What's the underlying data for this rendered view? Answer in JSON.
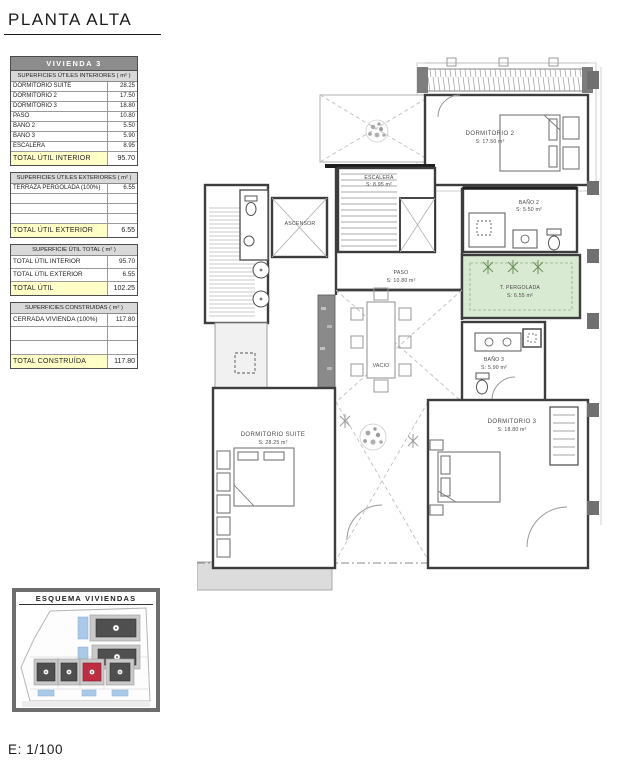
{
  "page": {
    "title": "PLANTA ALTA",
    "scale_label": "E: 1/100"
  },
  "colors": {
    "header_gray": "#8c8c8c",
    "subheader_gray": "#d9d9d9",
    "total_yellow": "#ffffc8",
    "pergola_green": "#d9ead3",
    "highlight_red": "#c02d42",
    "pool_blue": "#a9c9e9",
    "building_gray": "#4f4f4f"
  },
  "panel": {
    "unit_title": "VIVIENDA 3",
    "interior": {
      "header": "SUPERFICIES ÚTILES INTERIORES ( m² )",
      "rows": [
        {
          "label": "DORMITORIO SUITE",
          "value": "28.25"
        },
        {
          "label": "DORMITORIO 2",
          "value": "17.50"
        },
        {
          "label": "DORMITORIO 3",
          "value": "18.80"
        },
        {
          "label": "PASO",
          "value": "10.80"
        },
        {
          "label": "BAÑO 2",
          "value": "5.50"
        },
        {
          "label": "BAÑO 3",
          "value": "5.90"
        },
        {
          "label": "ESCALERA",
          "value": "8.95"
        }
      ],
      "total": {
        "label": "TOTAL ÚTIL INTERIOR",
        "value": "95.70"
      }
    },
    "exterior": {
      "header": "SUPERFICIES ÚTILES EXTERIORES ( m² )",
      "rows": [
        {
          "label": "TERRAZA PERGOLADA (100%)",
          "value": "6.55"
        }
      ],
      "total": {
        "label": "TOTAL ÚTIL EXTERIOR",
        "value": "6.55"
      }
    },
    "util_total": {
      "header": "SUPERFICIE ÚTIL TOTAL ( m² )",
      "rows": [
        {
          "label": "TOTAL ÚTIL INTERIOR",
          "value": "95.70"
        },
        {
          "label": "TOTAL ÚTIL EXTERIOR",
          "value": "6.55"
        }
      ],
      "total": {
        "label": "TOTAL ÚTIL",
        "value": "102.25"
      }
    },
    "construida": {
      "header": "SUPERFICIES CONSTRUIDAS ( m² )",
      "rows": [
        {
          "label": "CERRADA VIVIENDA (100%)",
          "value": "117.80"
        }
      ],
      "total": {
        "label": "TOTAL CONSTRUÍDA",
        "value": "117.80"
      }
    }
  },
  "plan": {
    "rooms": [
      {
        "name": "DORMITORIO 2",
        "area": "S: 17.50 m²"
      },
      {
        "name": "ESCALERA",
        "area": "S: 8.95 m²"
      },
      {
        "name": "ASCENSOR",
        "area": ""
      },
      {
        "name": "BAÑO 2",
        "area": "S: 5.50 m²"
      },
      {
        "name": "PASO",
        "area": "S: 10.80 m²"
      },
      {
        "name": "T. PERGOLADA",
        "area": "S: 6.55 m²"
      },
      {
        "name": "VACIO",
        "area": ""
      },
      {
        "name": "BAÑO 3",
        "area": "S: 5.90 m²"
      },
      {
        "name": "DORMITORIO SUITE",
        "area": "S: 28.25 m²"
      },
      {
        "name": "DORMITORIO 3",
        "area": "S: 18.80 m²"
      }
    ]
  },
  "esquema": {
    "title": "ESQUEMA VIVIENDAS"
  }
}
